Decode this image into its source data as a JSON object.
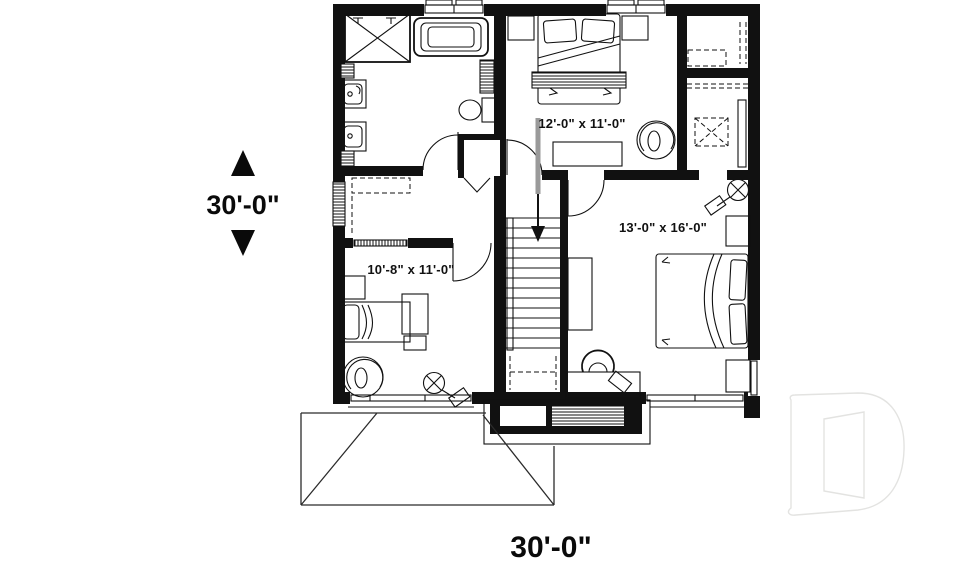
{
  "plan": {
    "overall_width_label": "30'-0\"",
    "overall_depth_label": "30'-0\"",
    "room_labels": {
      "bedroom_top": "12'-0\" x 11'-0\"",
      "master_bedroom": "13'-0\" x 16'-0\"",
      "bedroom_left": "10'-8\" x 11'-0\""
    },
    "stair_direction": "down",
    "colors": {
      "ink": "#111111",
      "arrow_gray": "#9a9a9a",
      "logo_outline": "#e3e3e1",
      "background": "#ffffff"
    }
  }
}
